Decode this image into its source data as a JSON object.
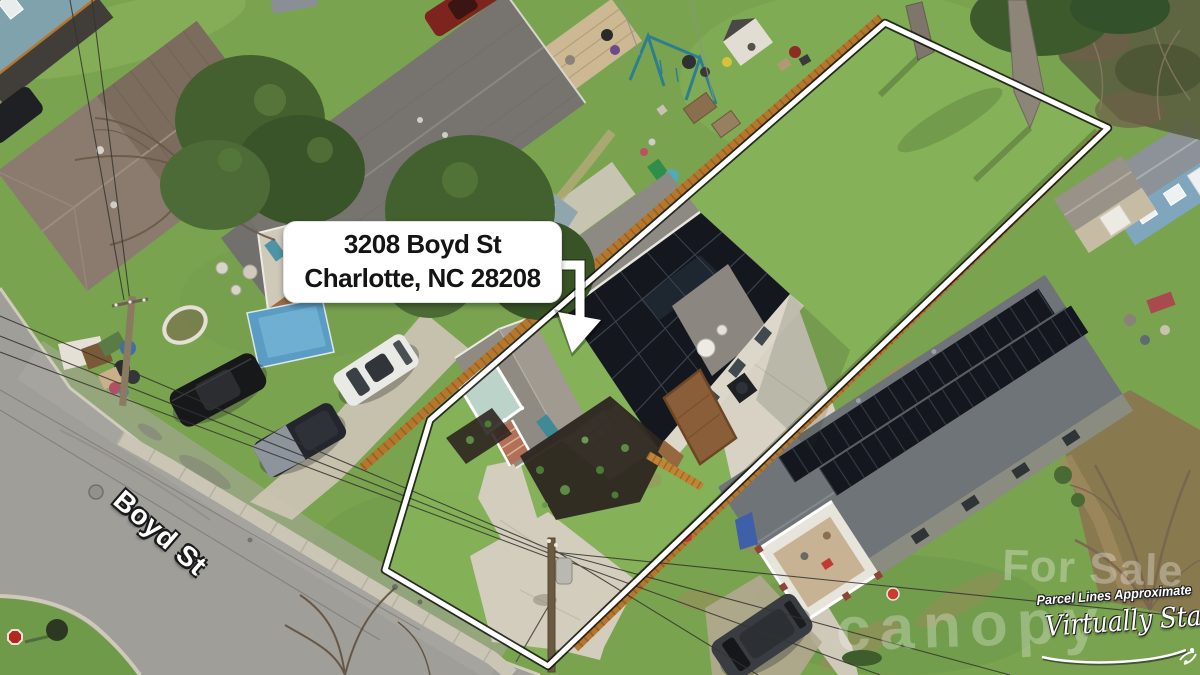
{
  "page": {
    "type": "aerial-real-estate-listing-photo"
  },
  "callout": {
    "address_line1": "3208 Boyd St",
    "address_line2": "Charlotte, NC 28208"
  },
  "street": {
    "label": "Boyd St"
  },
  "watermarks": {
    "for_sale": "For Sale",
    "brand": "canopy",
    "parcel_note": "Parcel Lines Approximate",
    "staged_note": "Virtually Staged"
  },
  "icons": {
    "arrow": "down-left-arrow-icon",
    "stop_sign": "stop-sign-icon"
  },
  "colors": {
    "parcel_line": "#ffffff",
    "parcel_line_shadow": "#15150f",
    "fence": "#b5772e",
    "solar_panel": "#14181e",
    "subject_roof": "#8d8a84",
    "right_neighbor_roof": "#6f7478",
    "left_neighbor_roof": "#8a7b6e",
    "grass": "#7aa350",
    "backyard_grass": "#82b157",
    "asphalt": "#a09e99",
    "concrete": "#d3cdbd",
    "mulch": "#2d2620",
    "porch_teal": "#3f8a96",
    "pool_blue": "#5a9cc4",
    "callout_bg": "#ffffff",
    "callout_text": "#141414"
  }
}
